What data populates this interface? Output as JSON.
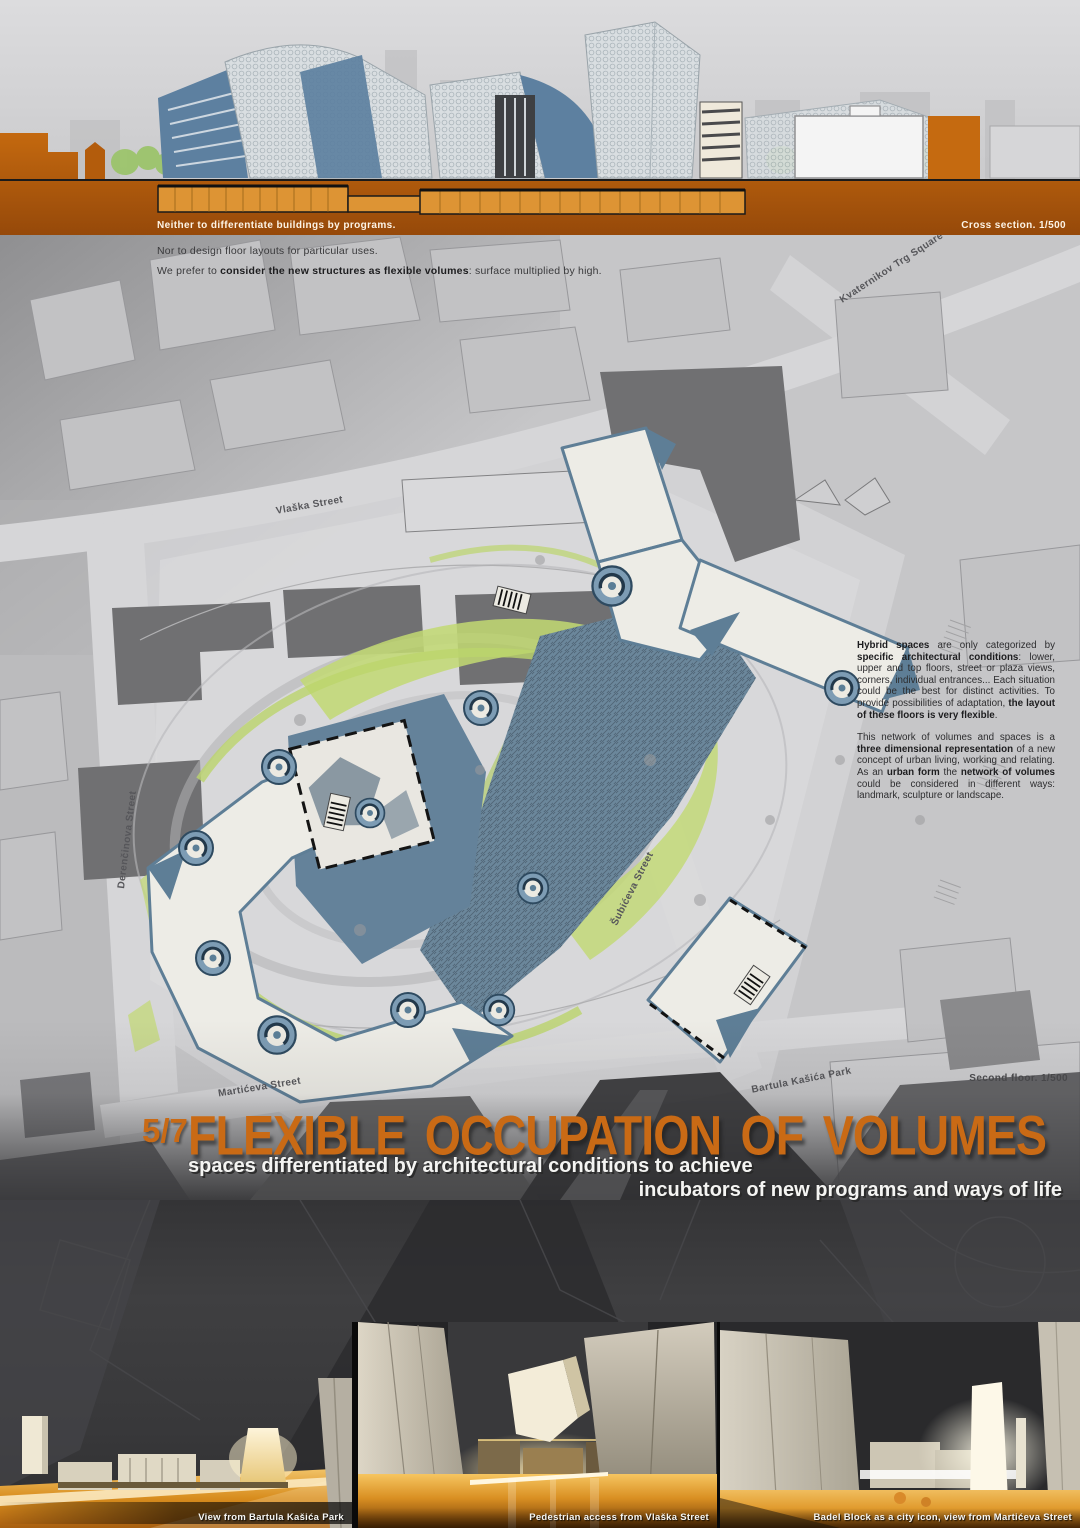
{
  "colors": {
    "accent_orange": "#c96a15",
    "band_orange": "#b05c0e",
    "section_fill_orange": "#dd9434",
    "steel_blue": "#5e7e96",
    "plan_green": "#bfd76f",
    "plan_white": "#edece6",
    "context_gray": "#707072",
    "dark_panel": "#39393b",
    "floor_amber": "#e09a2c"
  },
  "top_section": {
    "band_caption": "Neither to differentiate buildings by programs.",
    "scale_caption": "Cross section. 1/500",
    "statement_2": "Nor to design floor layouts for particular uses.",
    "statement_3_segments": [
      {
        "t": "We prefer to "
      },
      {
        "b": true,
        "t": "consider the new structures as flexible volumes"
      },
      {
        "t": ": surface multiplied by high."
      }
    ]
  },
  "plan": {
    "scale_caption": "Second floor. 1/500",
    "street_labels": {
      "kvaternikov": "Kvaternikov Trg Square",
      "vlaska": "Vlaška Street",
      "derencinova": "Derenčinova Street",
      "subiceva": "Šubićeva Street",
      "marticeva": "Martićeva Street",
      "bartula": "Bartula Kašića Park"
    },
    "hybrid_paragraph_segments": [
      {
        "b": true,
        "t": "Hybrid spaces"
      },
      {
        "t": " are only categorized by "
      },
      {
        "b": true,
        "t": "specific architectural conditions"
      },
      {
        "t": ": lower, upper and top floors, street or plaza views, corners, individual entrances... Each situation could be the best for distinct activities. To provide possibilities of adaptation, "
      },
      {
        "b": true,
        "t": "the layout of these floors is very flexible"
      },
      {
        "t": "."
      }
    ],
    "network_paragraph_segments": [
      {
        "t": "This network of volumes and spaces is a "
      },
      {
        "b": true,
        "t": "three dimensional representation"
      },
      {
        "t": " of a new concept of urban living, working and relating. As an "
      },
      {
        "b": true,
        "t": "urban form"
      },
      {
        "t": " the "
      },
      {
        "b": true,
        "t": "network of volumes"
      },
      {
        "t": " could be considered in different ways: landmark, sculpture or landscape."
      }
    ]
  },
  "title_block": {
    "page_number": "5/7",
    "heading": "FLEXIBLE OCCUPATION OF VOLUMES",
    "subtitle_line1": "spaces differentiated by architectural conditions to achieve",
    "subtitle_line2": "incubators of new programs and ways of life"
  },
  "renders": [
    {
      "caption": "View from Bartula Kašića Park"
    },
    {
      "caption": "Pedestrian access from Vlaška Street"
    },
    {
      "caption": "Badel Block as a city icon, view from Martićeva Street"
    }
  ]
}
